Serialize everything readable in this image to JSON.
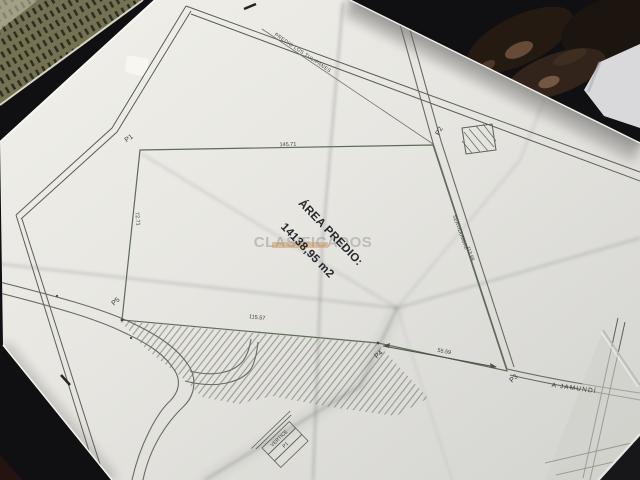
{
  "plan": {
    "area_title": "ÁREA PREDIO:",
    "area_value": "14138,95 m2",
    "vertex_labels": {
      "p1": "P1",
      "p2": "P2",
      "p3": "P3",
      "p4": "P4",
      "p5": "P5"
    },
    "dimensions": {
      "p1_p2": "145.71",
      "p1_p5": "72.71",
      "p5_p4": "115.57",
      "p4_p3": "55.59",
      "servidumbre_length": "113.99"
    },
    "road_labels": {
      "servidumbre": "SERVIDUMBRE",
      "jamundi": "A JAMUNDÍ"
    },
    "neighbor_parcel_label": "PREDIO LOS TULIPANES",
    "vertex_table": {
      "header": "VERTICE",
      "row1": "P1"
    },
    "watermark_text": "CLASIFICADOS"
  },
  "colors": {
    "paper": "#e9e8e3",
    "table_surface": "#101013",
    "plan_ink": "#5c5f56",
    "parcel_line": "#5e6b57",
    "label_ink": "#3b3e39",
    "watermark_gray": "#9c9c98",
    "watermark_bar": "#d7a97b"
  }
}
